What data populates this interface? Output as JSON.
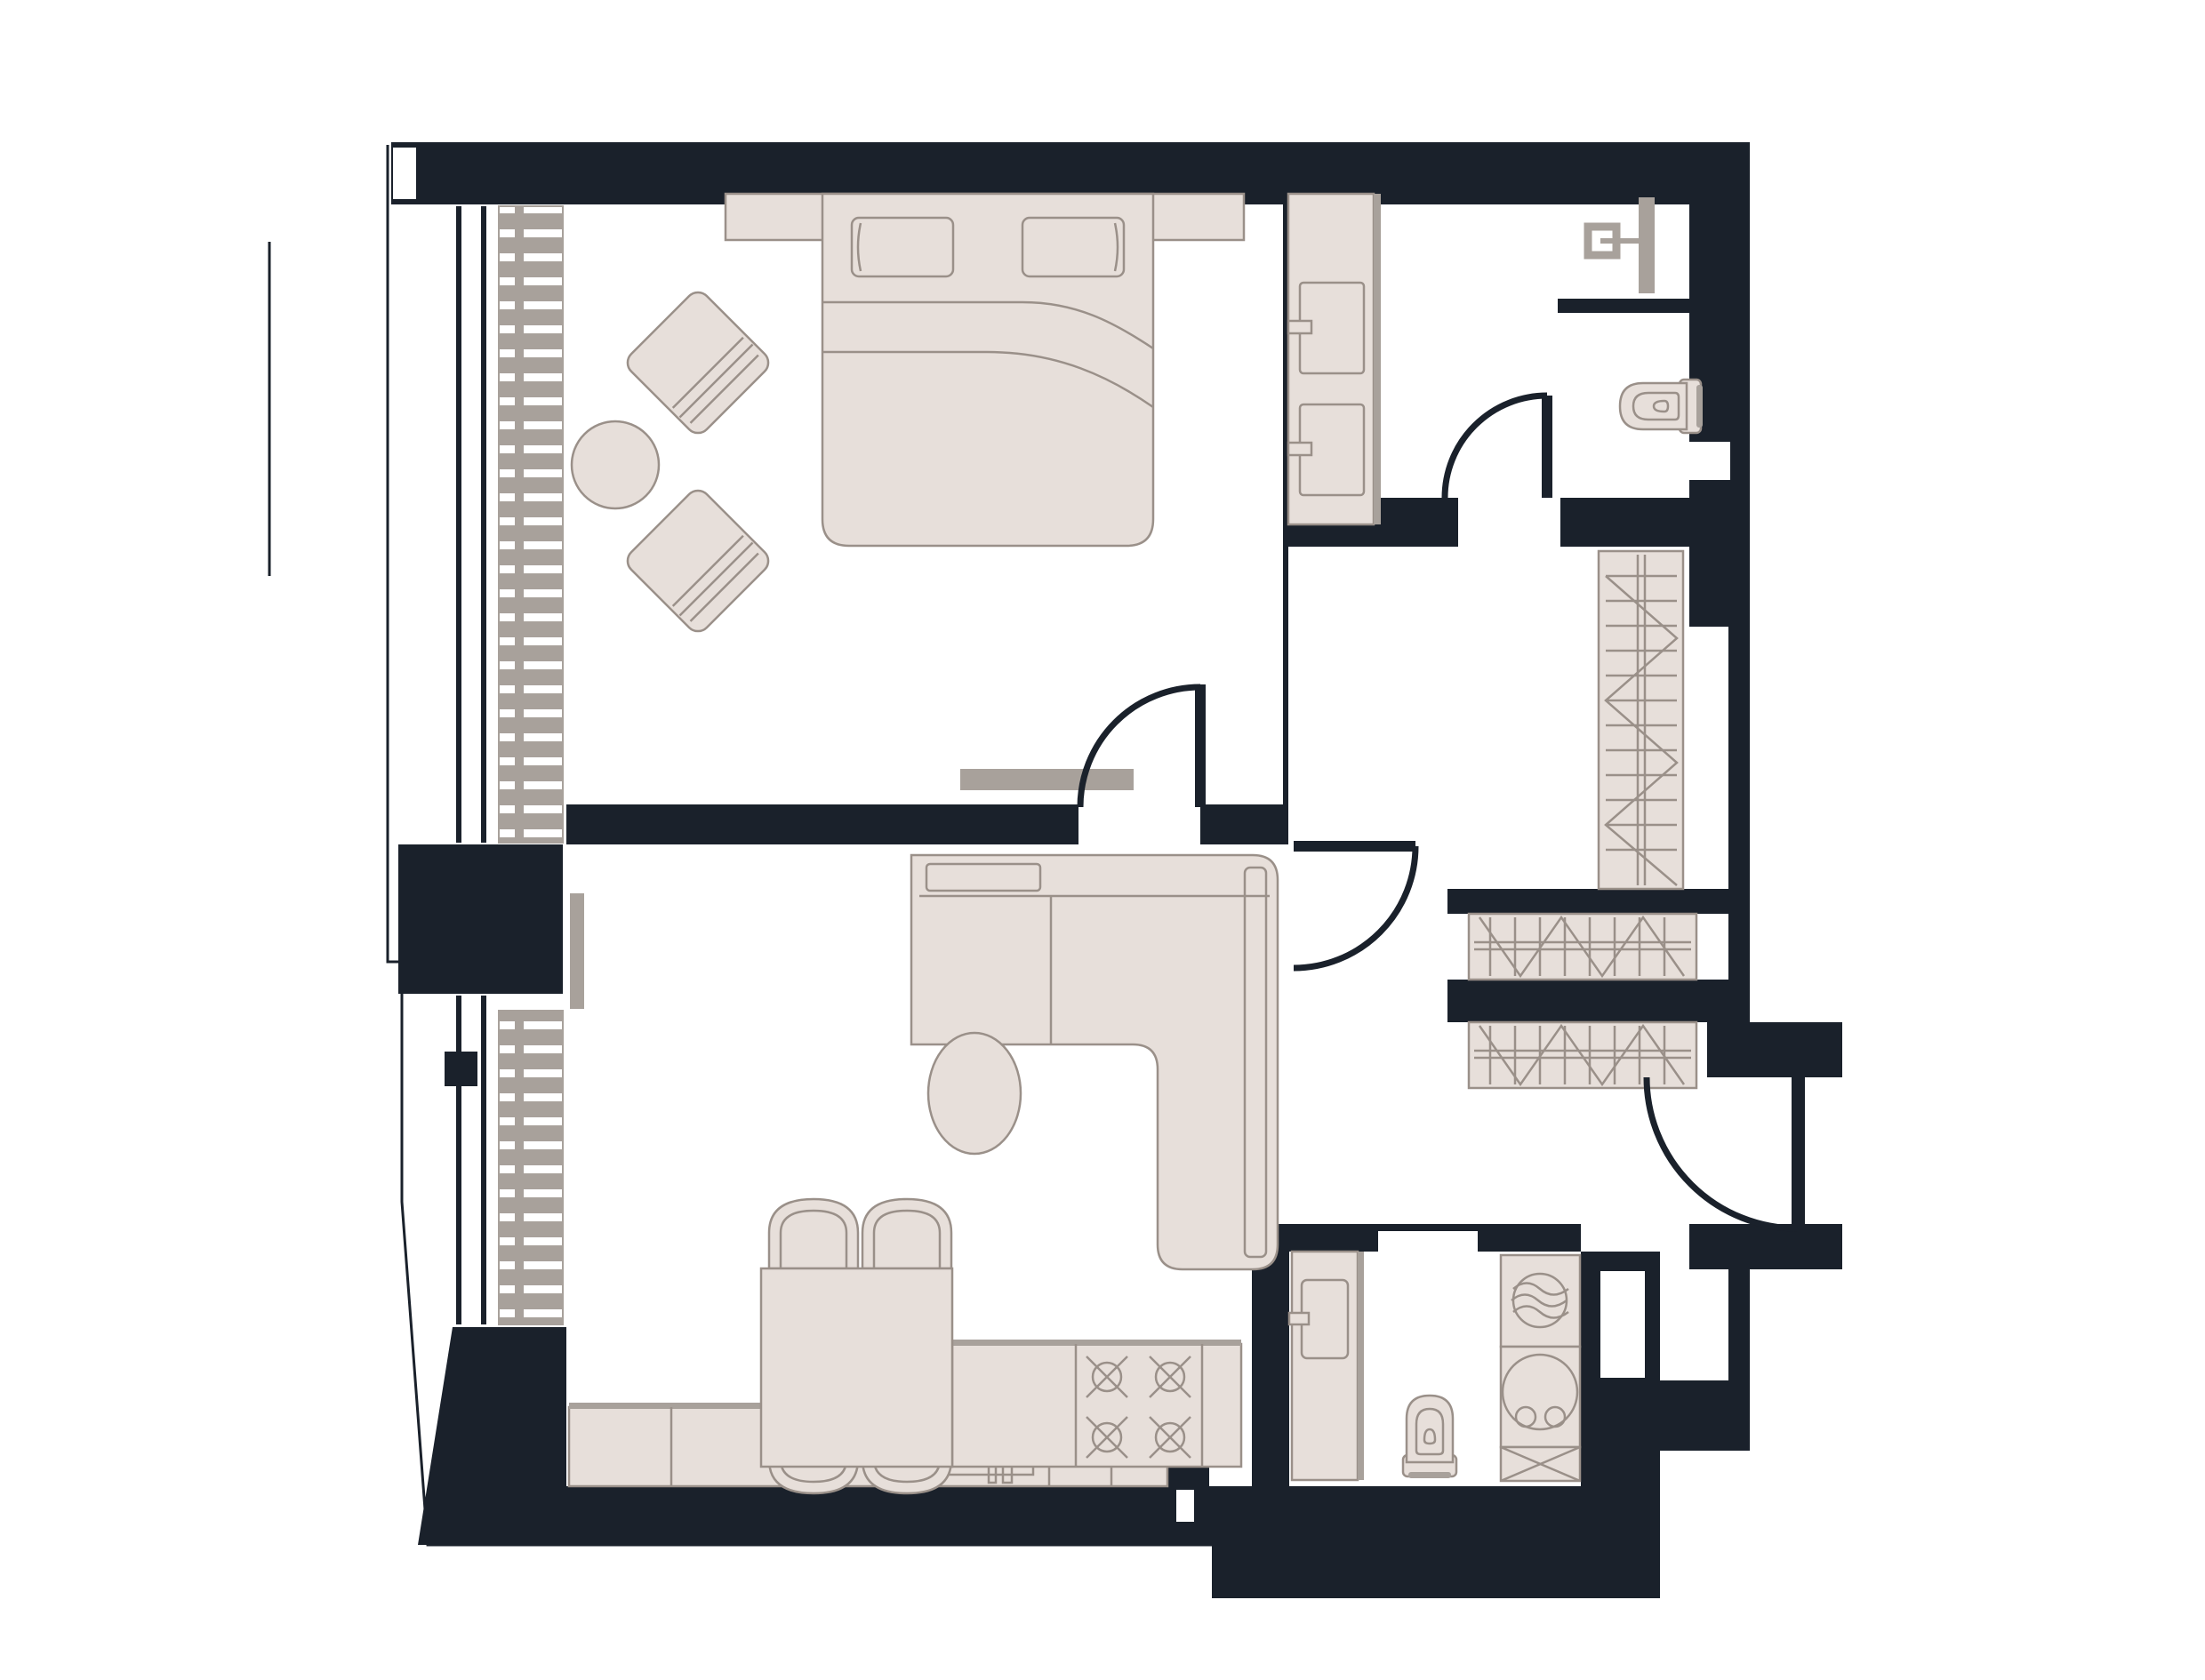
{
  "meta": {
    "title": "One-bedroom apartment floor plan, top-down architectural view",
    "type": "floor-plan",
    "visible_text": "none"
  },
  "palette": {
    "wall": "#1a212b",
    "furn": "#e7dfda",
    "furnStroke": "#9a9089",
    "gray": "#a8a19b",
    "floor": "#ffffff"
  },
  "rooms": [
    {
      "id": "bedroom",
      "name": "Bedroom",
      "furniture": [
        "double-bed",
        "headboard-bench-with-nightstands",
        "pillow-left",
        "pillow-right",
        "armchair-top",
        "armchair-bottom",
        "round-side-table",
        "tv-console",
        "radiator",
        "double-glazed-window"
      ]
    },
    {
      "id": "bathroom-main",
      "name": "Main bathroom",
      "furniture": [
        "double-washbasin-vanity",
        "shower-head-fixture",
        "shower-glass-panel",
        "wall-hung-toilet",
        "half-partition-wall",
        "swing-door"
      ]
    },
    {
      "id": "hallway",
      "name": "Hallway with closets",
      "furniture": [
        "vertical-hanging-wardrobe",
        "horizontal-wardrobe-upper",
        "horizontal-wardrobe-lower",
        "bedroom-swing-door",
        "living-room-swing-door"
      ]
    },
    {
      "id": "living-kitchen",
      "name": "Living room with open kitchen",
      "furniture": [
        "corner-sofa-with-chaise",
        "oval-coffee-table",
        "tv-panel",
        "dining-table",
        "dining-chair-1",
        "dining-chair-2",
        "dining-chair-3",
        "dining-chair-4",
        "kitchen-island",
        "cooktop-four-burners",
        "kitchen-counter-run",
        "kitchen-sink",
        "dishwasher-drops-icon",
        "freezer-asterisks-icon",
        "radiator",
        "double-glazed-window"
      ]
    },
    {
      "id": "laundry-bathroom",
      "name": "Laundry bathroom",
      "furniture": [
        "washbasin-cabinet",
        "toilet",
        "dryer-swirl-unit",
        "washing-machine",
        "crossed-service-box",
        "pocket-door-opening"
      ]
    },
    {
      "id": "entry",
      "name": "Entry vestibule",
      "furniture": [
        "entrance-swing-door"
      ]
    }
  ],
  "icons": {
    "drops": "dishwasher-symbol",
    "asterisks": "freezer-symbol",
    "swirl": "dryer-fan-symbol",
    "circle-cross": "gas-burner-symbol",
    "zigzag": "wardrobe-hanger-rail-symbol",
    "ladder-strip": "radiator-symbol",
    "quarter-arc": "door-swing-symbol",
    "x-box": "service-shaft-symbol"
  }
}
